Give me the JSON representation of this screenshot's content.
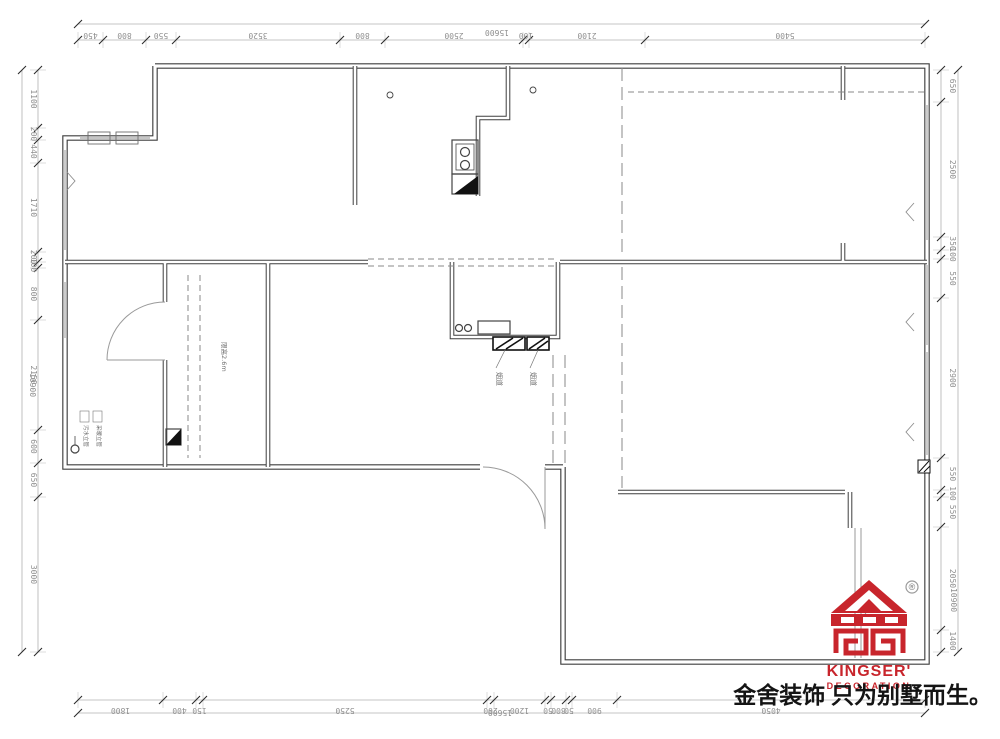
{
  "plan": {
    "annotations": {
      "flue_label_1": "烟道",
      "flue_label_2": "烟道",
      "pipe_label_1": "污水立管",
      "pipe_label_2": "采暖立管",
      "room_note": "限高2.6m"
    },
    "colors": {
      "wall": "#3f3f3f",
      "dim_line": "#b0b0b0",
      "dim_text": "#8f8f8f",
      "accent_red": "#c8252c"
    }
  },
  "dimensions": {
    "top": {
      "total": "15600",
      "segments": [
        "450",
        "800",
        "550",
        "3520",
        "800",
        "2500",
        "100",
        "2100",
        "5400"
      ]
    },
    "bottom": {
      "total": "15600",
      "segments": [
        "1800",
        "400",
        "150",
        "5250",
        "200",
        "1200",
        "50",
        "800",
        "50",
        "900",
        "4050"
      ]
    },
    "left": {
      "total": "10900",
      "segments": [
        "1100",
        "200",
        "440",
        "1710",
        "200",
        "100",
        "800",
        "2150",
        "600",
        "650",
        "3000"
      ]
    },
    "right": {
      "total": "10900",
      "segments": [
        "650",
        "2500",
        "350",
        "100",
        "550",
        "2900",
        "550",
        "100",
        "550",
        "2050",
        "1400"
      ]
    }
  },
  "branding": {
    "logo_text": "KINGSER'",
    "logo_subtext": "DECORATION",
    "registered_mark": "®",
    "slogan": "金舍装饰 只为别墅而生。"
  }
}
